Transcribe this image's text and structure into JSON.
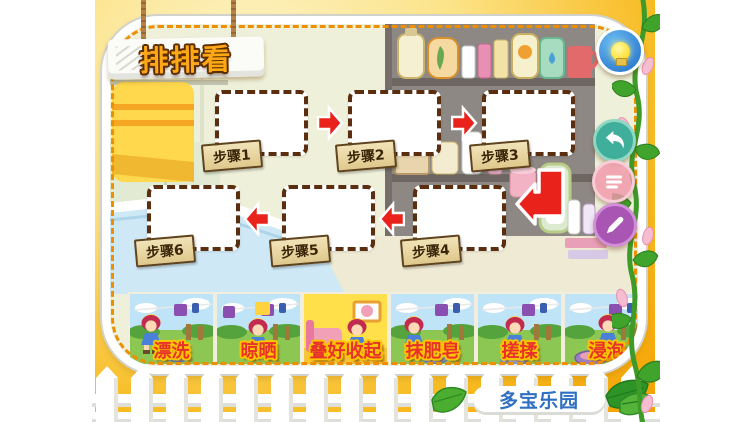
{
  "header": {
    "title": "排排看"
  },
  "steps": [
    {
      "label": "步骤1"
    },
    {
      "label": "步骤2"
    },
    {
      "label": "步骤3"
    },
    {
      "label": "步骤4"
    },
    {
      "label": "步骤5"
    },
    {
      "label": "步骤6"
    }
  ],
  "flow": {
    "arrows": [
      "right",
      "right",
      "bend-down-left",
      "left",
      "left"
    ]
  },
  "cards": [
    {
      "label": "漂洗",
      "scene": "outdoor-rinsing"
    },
    {
      "label": "晾晒",
      "scene": "outdoor-hanging"
    },
    {
      "label": "叠好收起",
      "scene": "indoor-folding",
      "highlight": true
    },
    {
      "label": "抹肥皂",
      "scene": "outdoor-soaping"
    },
    {
      "label": "搓揉",
      "scene": "outdoor-scrubbing"
    },
    {
      "label": "浸泡",
      "scene": "outdoor-soaking"
    }
  ],
  "toolbar": {
    "buttons": [
      {
        "name": "hint",
        "icon": "light-bulb"
      },
      {
        "name": "undo",
        "icon": "back-arrow"
      },
      {
        "name": "steps-list",
        "icon": "list"
      },
      {
        "name": "draw",
        "icon": "pencil"
      }
    ]
  },
  "footer": {
    "brand": "多宝乐园"
  },
  "colors": {
    "arrow_red": "#e9231b",
    "panel_dash_orange": "#ee8e00",
    "background_orange": "#f5a000",
    "card_label_fill": "#e8312a",
    "card_label_outline": "#fdc500",
    "brand_blue": "#2f6fc1",
    "step_tag_wood": "#e9d8a2",
    "box_border_brown": "#5b2e10",
    "card_highlight_yellow": "#ffdf4a"
  }
}
